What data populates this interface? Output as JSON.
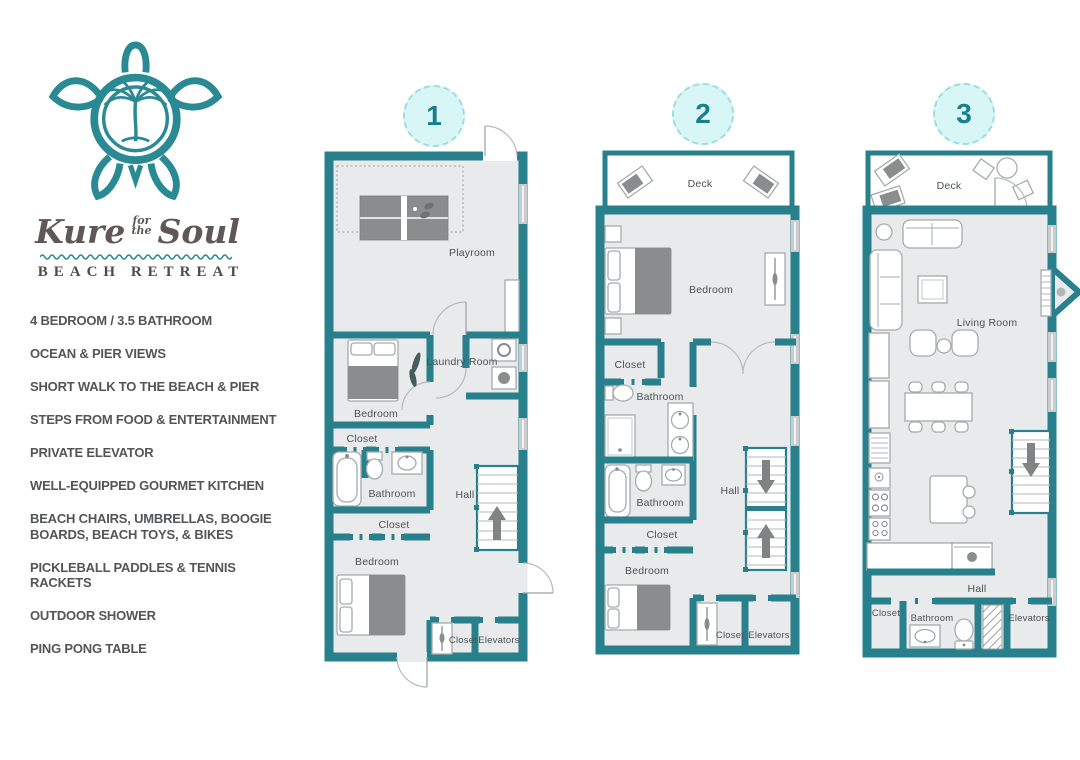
{
  "brand": {
    "logo_icon": "sea-turtle-with-palm-tree-logo",
    "script_word_1": "Kure",
    "script_small_top": "for",
    "script_small_bottom": "the",
    "script_word_2": "Soul",
    "subtitle": "BEACH RETREAT"
  },
  "colors": {
    "accent_teal": "#27808c",
    "logo_teal": "#2a8a94",
    "circle_fill": "#d9f6f6",
    "circle_border": "#9adde2",
    "floor_gray": "#e9eaeb",
    "furniture_dark": "#8a8c8e",
    "text_dark": "#545557"
  },
  "amenities": [
    "4 BEDROOM / 3.5 BATHROOM",
    "OCEAN & PIER VIEWS",
    "SHORT WALK TO THE BEACH & PIER",
    "STEPS FROM FOOD & ENTERTAINMENT",
    "PRIVATE ELEVATOR",
    "WELL-EQUIPPED GOURMET KITCHEN",
    "BEACH CHAIRS, UMBRELLAS, BOOGIE\nBOARDS, BEACH TOYS, & BIKES",
    "PICKLEBALL PADDLES & TENNIS RACKETS",
    "OUTDOOR SHOWER",
    "PING PONG TABLE"
  ],
  "floors": [
    {
      "number": "1",
      "rooms": {
        "playroom": "Playroom",
        "laundry": "Laundry Room",
        "bedroom_mid": "Bedroom",
        "closet_mid": "Closet",
        "bathroom": "Bathroom",
        "hall": "Hall",
        "closet_lower": "Closet",
        "bedroom_lower": "Bedroom",
        "closet_entry": "Closet",
        "elevators": "Elevators"
      }
    },
    {
      "number": "2",
      "rooms": {
        "deck": "Deck",
        "bedroom_upper": "Bedroom",
        "closet_upper": "Closet",
        "bathroom_upper": "Bathroom",
        "bathroom_lower": "Bathroom",
        "hall": "Hall",
        "closet_mid": "Closet",
        "bedroom_lower": "Bedroom",
        "closet_entry": "Closet",
        "elevators": "Elevators"
      }
    },
    {
      "number": "3",
      "rooms": {
        "deck": "Deck",
        "living_room": "Living Room",
        "hall": "Hall",
        "closet": "Closet",
        "bathroom": "Bathroom",
        "elevators": "Elevators"
      }
    }
  ]
}
